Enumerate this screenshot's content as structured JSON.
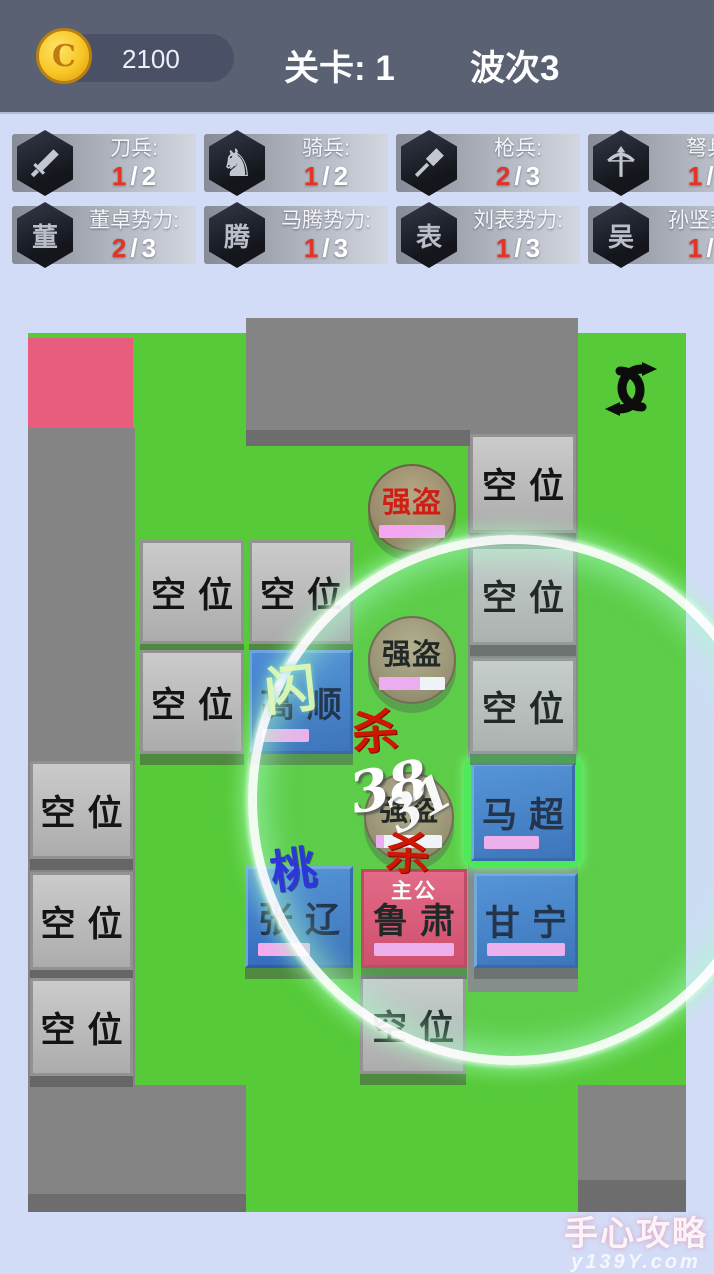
{
  "topbar": {
    "coins": "2100",
    "coin_glyph": "C",
    "level": "关卡: 1",
    "wave": "波次3"
  },
  "ui": {
    "sep": "/"
  },
  "unit_badges": [
    {
      "icon": "sword-icon",
      "label": "刀兵:",
      "current": "1",
      "max": "2"
    },
    {
      "icon": "horse-icon",
      "label": "骑兵:",
      "current": "1",
      "max": "2"
    },
    {
      "icon": "spear-icon",
      "label": "枪兵:",
      "current": "2",
      "max": "3"
    },
    {
      "icon": "crossbow-icon",
      "label": "弩兵:",
      "current": "1",
      "max": "2"
    }
  ],
  "faction_badges": [
    {
      "glyph": "董",
      "label": "董卓势力:",
      "current": "2",
      "max": "3"
    },
    {
      "glyph": "腾",
      "label": "马腾势力:",
      "current": "1",
      "max": "3"
    },
    {
      "glyph": "表",
      "label": "刘表势力:",
      "current": "1",
      "max": "3"
    },
    {
      "glyph": "吴",
      "label": "孙坚势力",
      "current": "1",
      "max": "2"
    }
  ],
  "board": {
    "empty_label": "空位",
    "lord_tag": "主公"
  },
  "heroes": {
    "gaoshun": {
      "name": "高顺",
      "hp_style": "width:47px"
    },
    "machao": {
      "name": "马超",
      "hp_style": "width:55px"
    },
    "zhangliao": {
      "name": "张辽",
      "hp_style": "width:52px"
    },
    "lusu": {
      "name": "鲁肃",
      "hp_style": "width:80px"
    },
    "ganning": {
      "name": "甘宁",
      "hp_style": "width:78px"
    }
  },
  "bandits": {
    "label": "强盗",
    "b1": {
      "hp_style": "width:100%"
    },
    "b2": {
      "hp_style": "width:62%"
    },
    "b3": {
      "hp_style": "width:12%"
    }
  },
  "effects": {
    "kill": "杀",
    "damage": "38",
    "damage_fading": "31",
    "dodge": "闪",
    "peach": "桃"
  },
  "watermark": {
    "line1": "手心攻略",
    "line2": "y139Y.com"
  },
  "colors": {
    "board_green": "#56ca39",
    "path_gray": "#848484",
    "spawn_pink": "#e85d7d",
    "hero_blue": "#3c7ecf",
    "lord_pink": "#e3496e",
    "hp_pink": "#f4abef",
    "selected_green": "#46e94b",
    "alert_red": "#e33327",
    "topbar_slate": "#596173"
  }
}
